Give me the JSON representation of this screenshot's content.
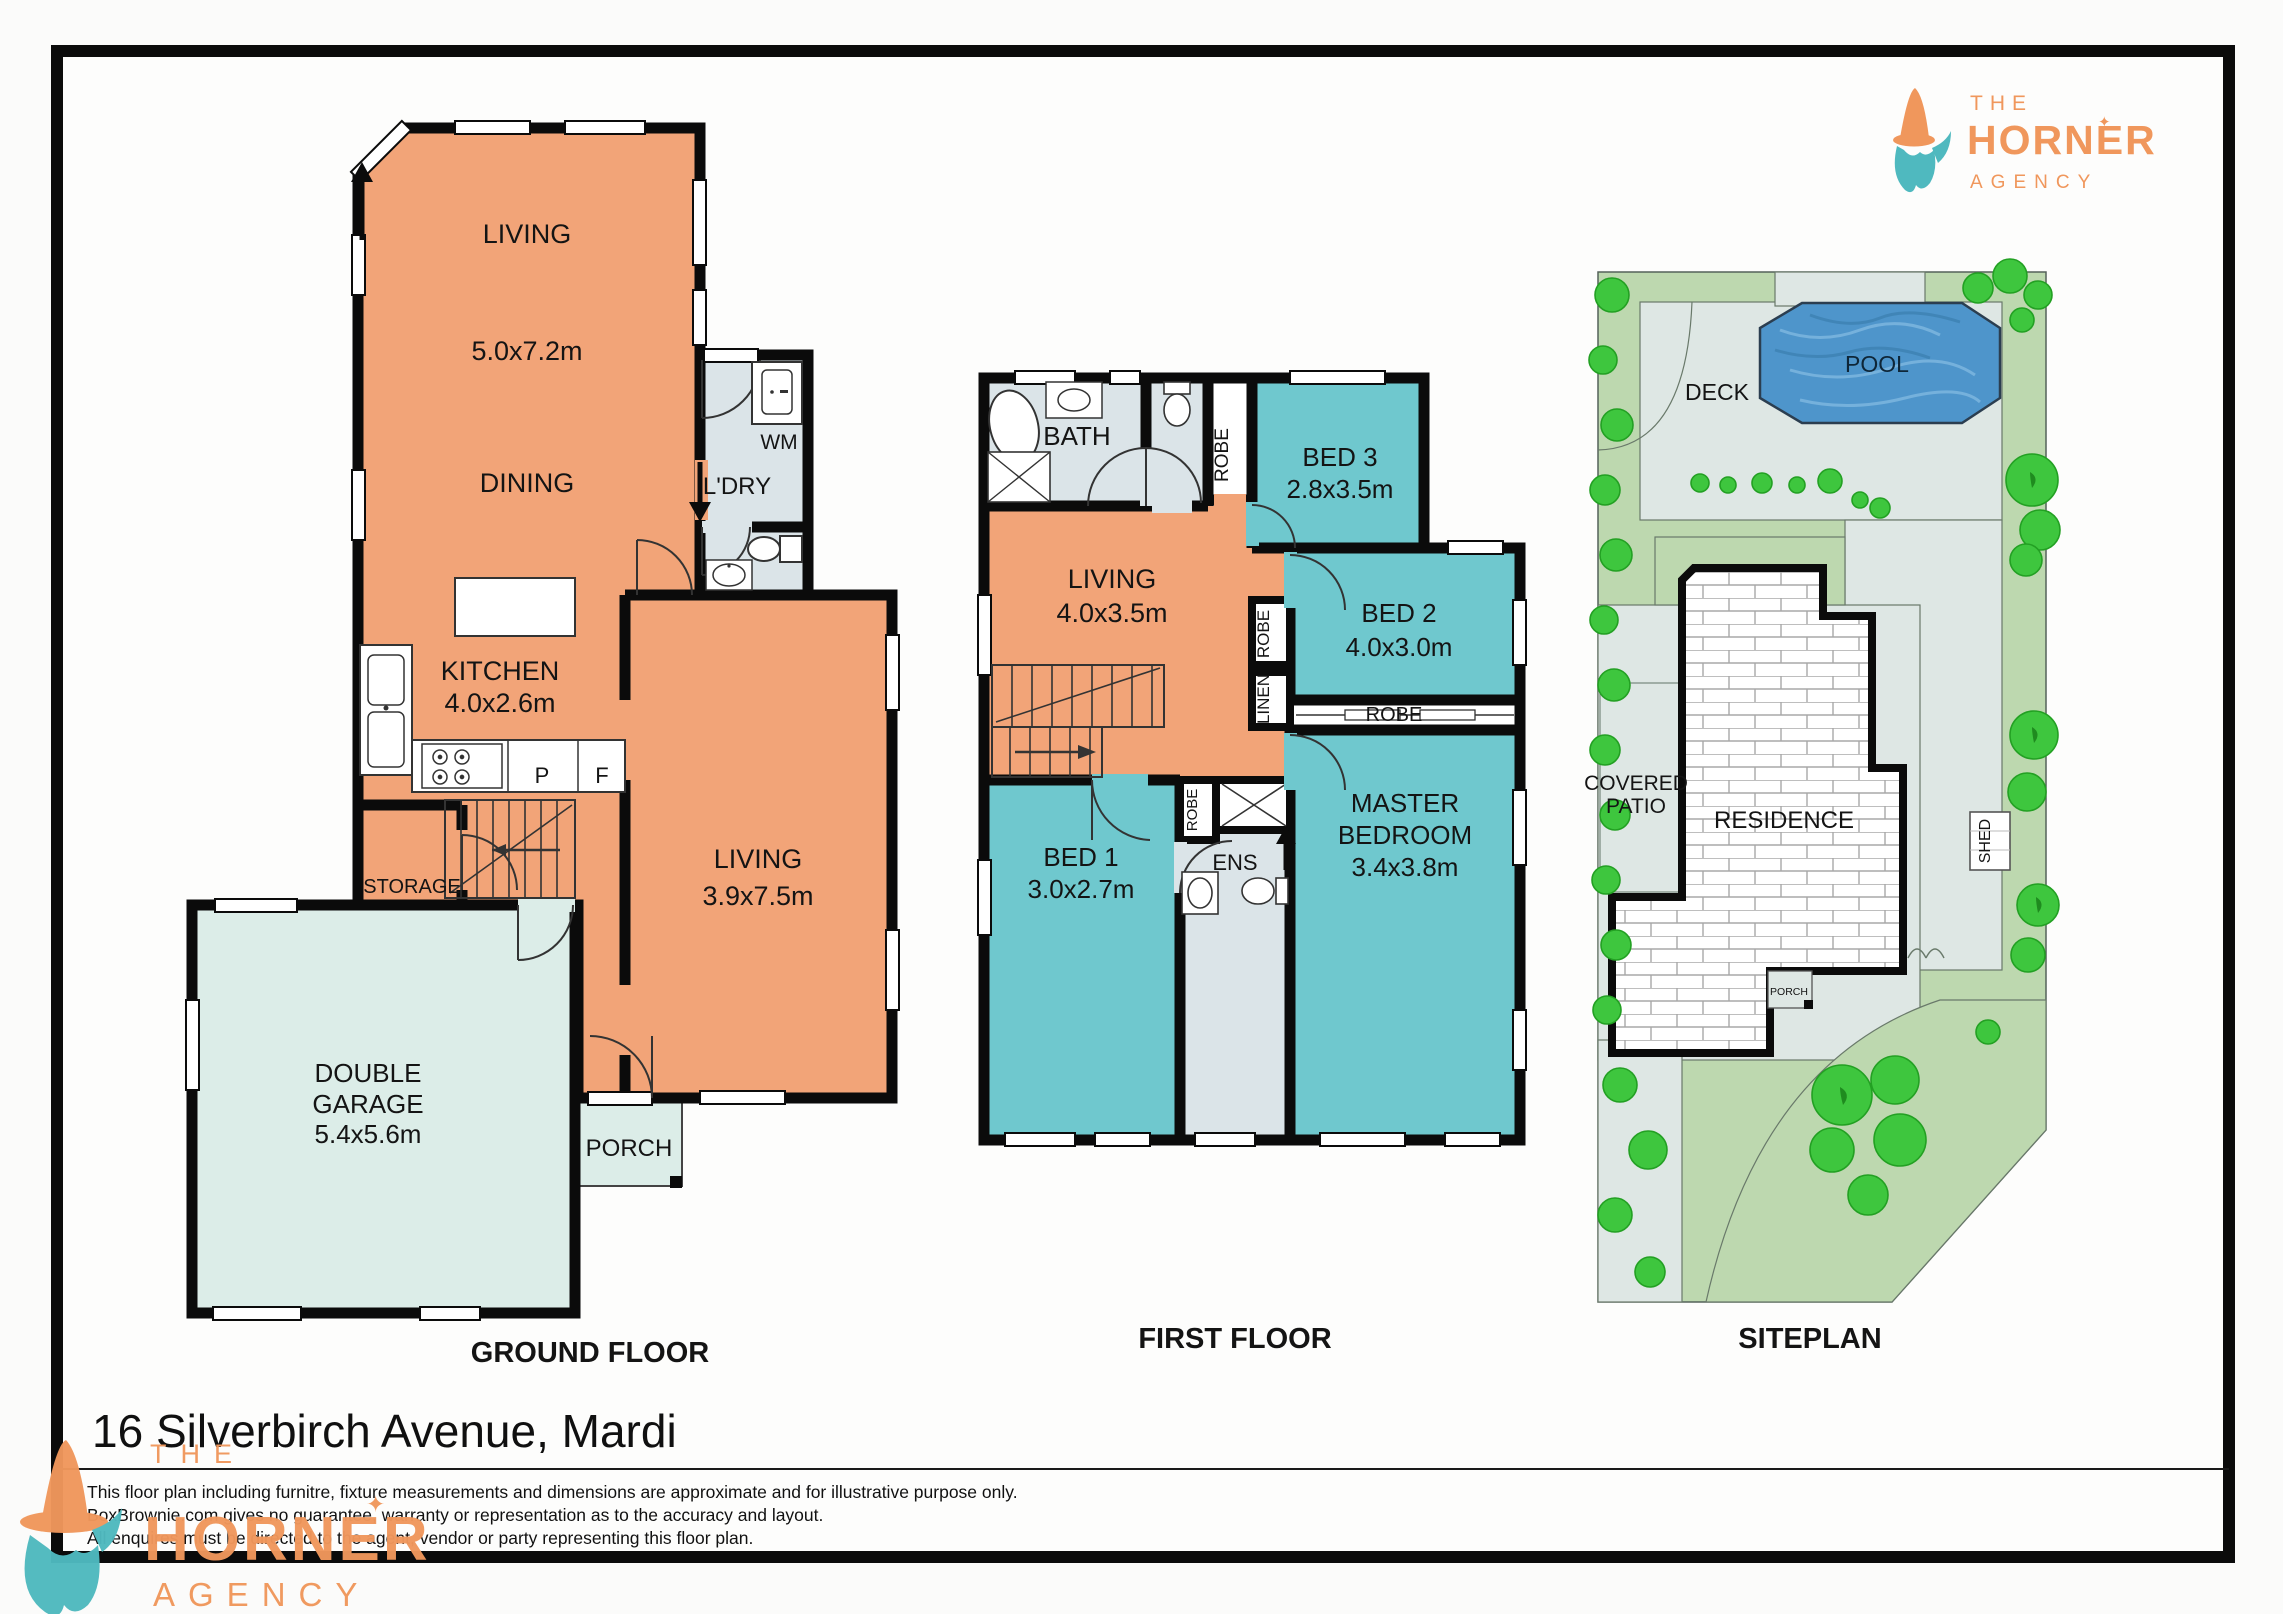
{
  "page": {
    "title": "16 Silverbirch Avenue, Mardi",
    "disclaimer": [
      "This floor plan including furnitre, fixture measurements and dimensions are approximate and for illustrative purpose only.",
      "BoxBrownie.com gives no guarantee, warranty or representation as to the accuracy and layout.",
      "All enquires must be directed to the agent, vendor or party representing this floor plan."
    ]
  },
  "brand": {
    "line1": "THE",
    "name": "HORNER",
    "line3": "AGENCY",
    "star": "✦",
    "orange": "#F0975C",
    "teal": "#4FB9BF"
  },
  "colors": {
    "room_orange": "#F2A478",
    "room_teal": "#6FC8CE",
    "room_wet": "#DBE4E8",
    "room_garage": "#DCEDE8",
    "wall_black": "#0b0b0b",
    "site_lawn": "#BDD8AF",
    "site_paving": "#DEE7E4",
    "tree_green": "#3EC63E",
    "pool_blue": "#4E95CB"
  },
  "floors": {
    "ground": {
      "title": "GROUND FLOOR",
      "rooms": {
        "living1": {
          "name": "LIVING",
          "dims": "5.0x7.2m"
        },
        "dining": {
          "name": "DINING"
        },
        "laundry": {
          "name": "L'DRY"
        },
        "wm": {
          "name": "WM"
        },
        "kitchen": {
          "name": "KITCHEN",
          "dims": "4.0x2.6m"
        },
        "pantry": {
          "name": "P"
        },
        "fridge": {
          "name": "F"
        },
        "living2": {
          "name": "LIVING",
          "dims": "3.9x7.5m"
        },
        "storage": {
          "name": "STORAGE"
        },
        "garage": {
          "name1": "DOUBLE",
          "name2": "GARAGE",
          "dims": "5.4x5.6m"
        },
        "porch": {
          "name": "PORCH"
        }
      }
    },
    "first": {
      "title": "FIRST FLOOR",
      "rooms": {
        "bath": {
          "name": "BATH"
        },
        "robe": {
          "name": "ROBE"
        },
        "linen": {
          "name": "LINEN"
        },
        "bed3": {
          "name": "BED 3",
          "dims": "2.8x3.5m"
        },
        "living": {
          "name": "LIVING",
          "dims": "4.0x3.5m"
        },
        "bed2": {
          "name": "BED 2",
          "dims": "4.0x3.0m"
        },
        "master": {
          "name1": "MASTER",
          "name2": "BEDROOM",
          "dims": "3.4x3.8m"
        },
        "bed1": {
          "name": "BED 1",
          "dims": "3.0x2.7m"
        },
        "ens": {
          "name": "ENS"
        }
      }
    },
    "site": {
      "title": "SITEPLAN",
      "labels": {
        "deck": "DECK",
        "pool": "POOL",
        "patio1": "COVERED",
        "patio2": "PATIO",
        "residence": "RESIDENCE",
        "shed": "SHED",
        "porch": "PORCH"
      }
    }
  }
}
